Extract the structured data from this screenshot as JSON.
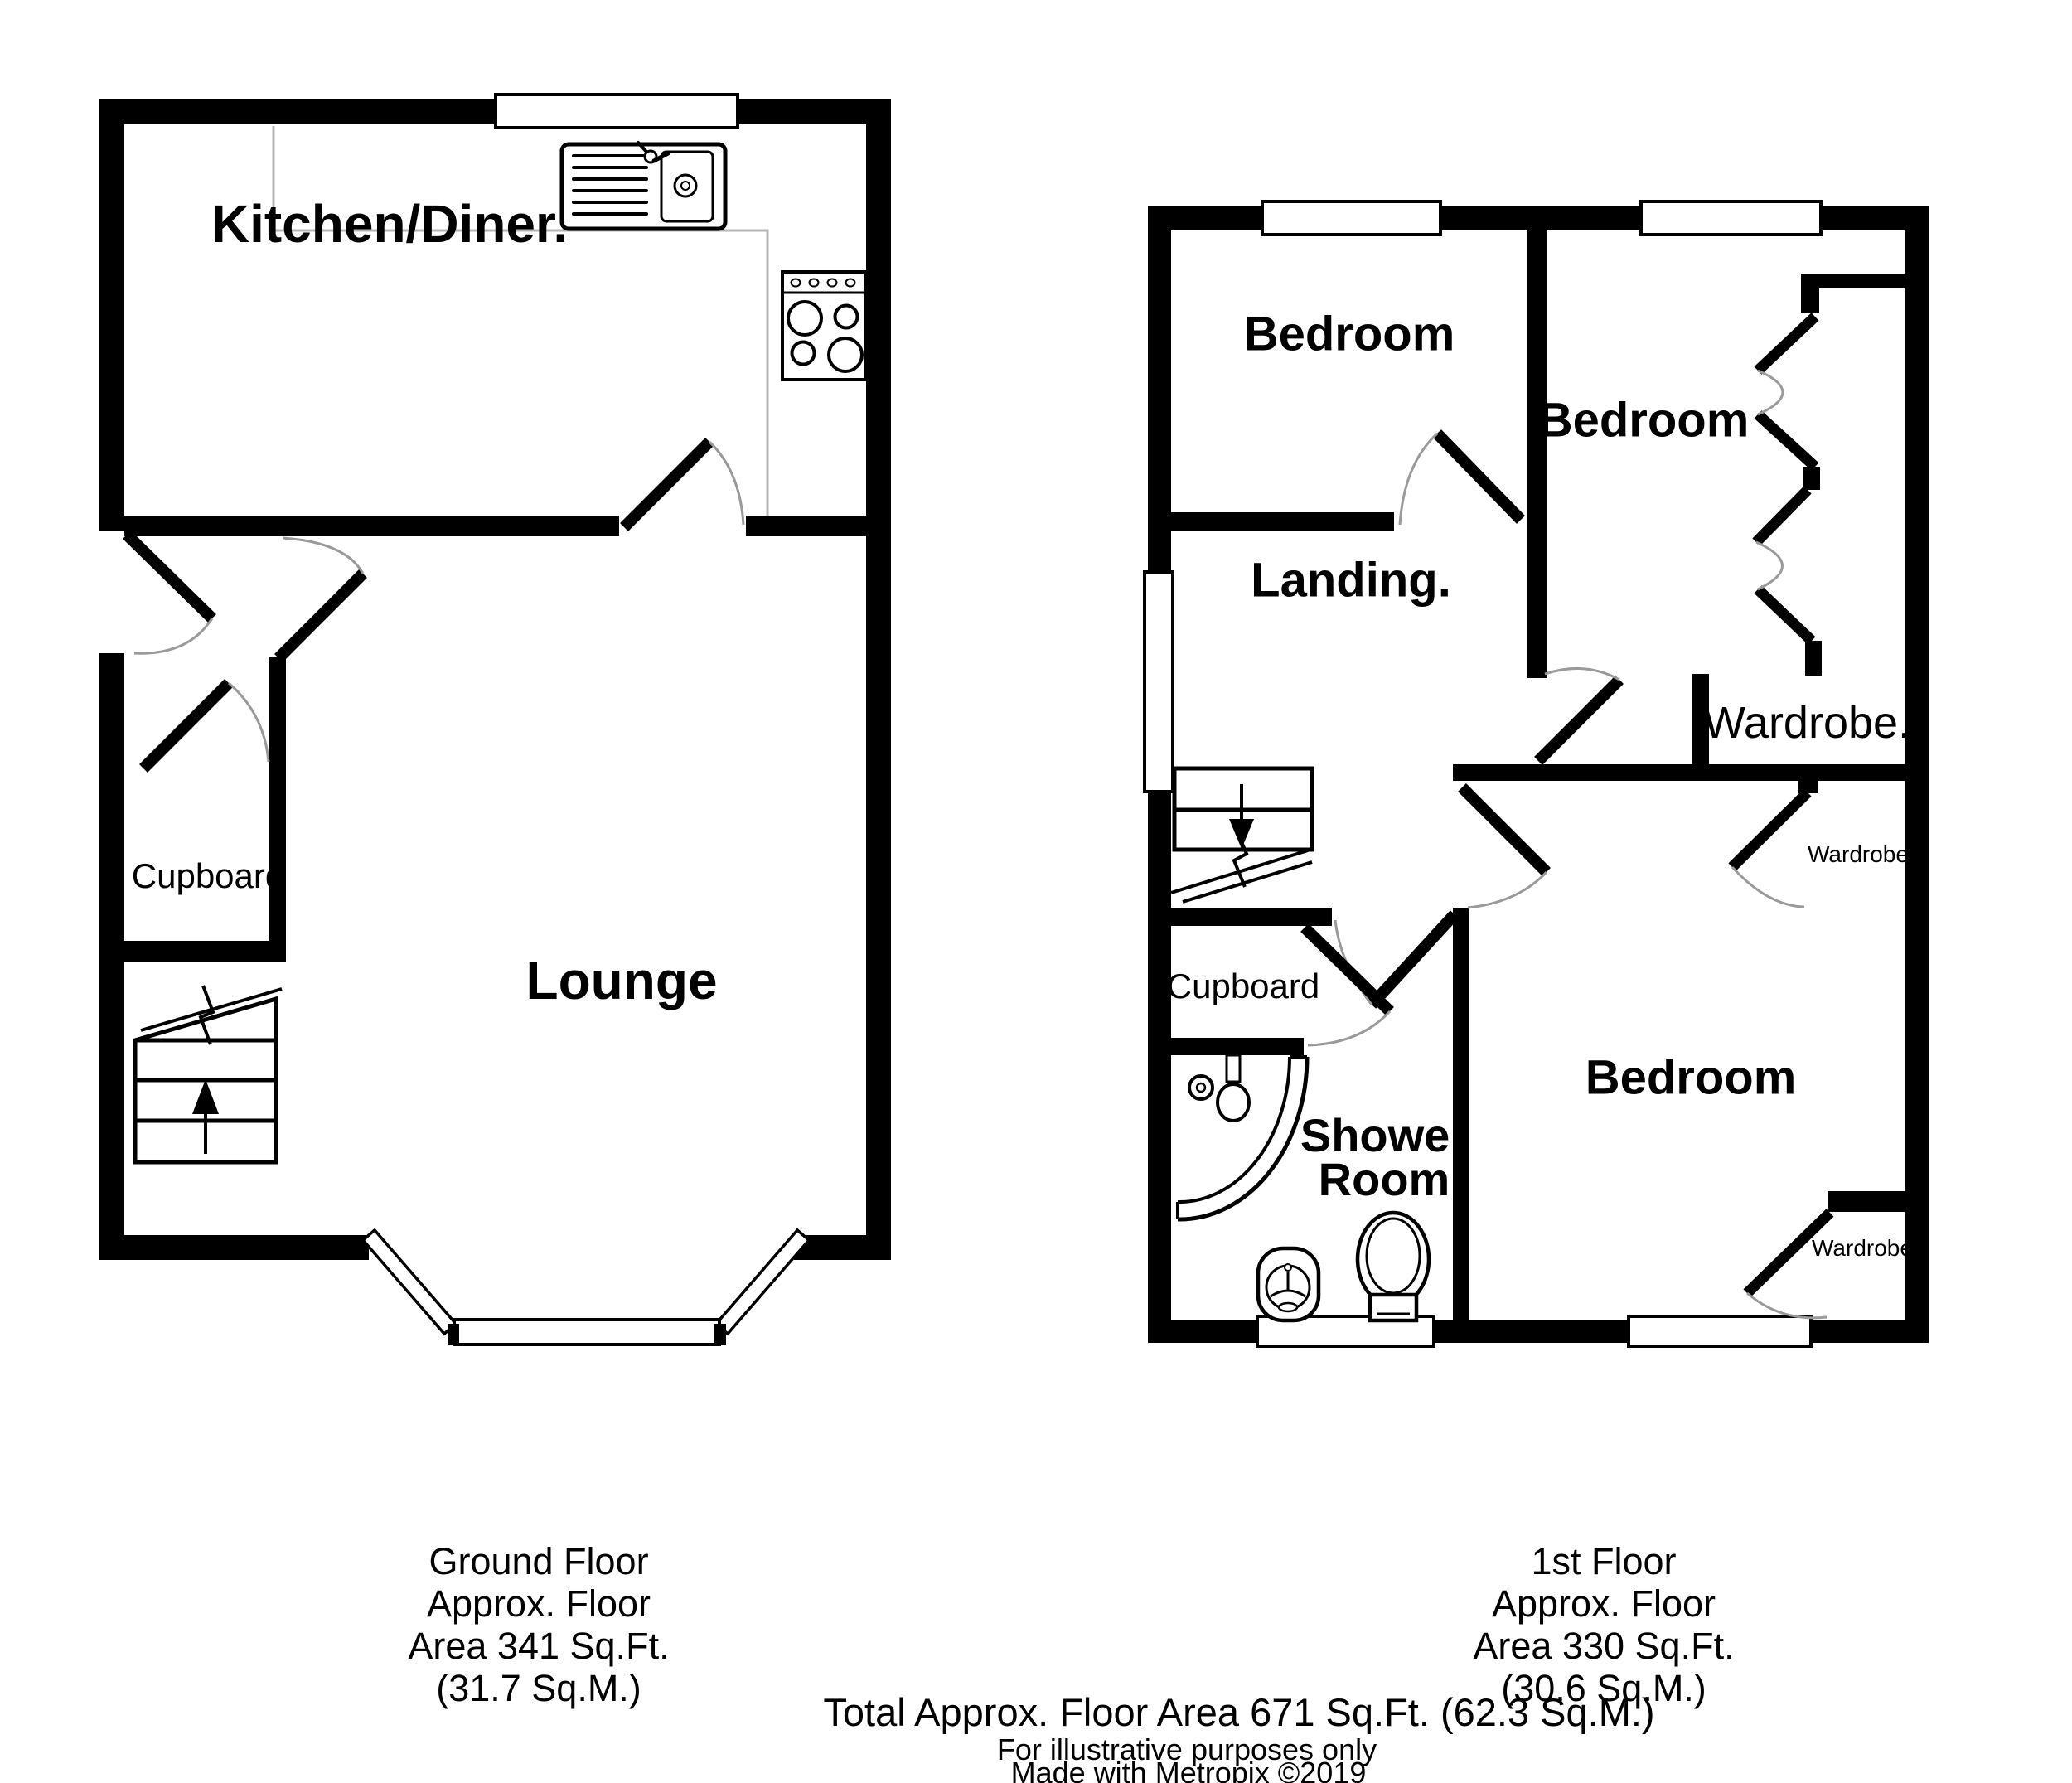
{
  "page": {
    "background": "#ffffff",
    "wall_color": "#000000",
    "door_arc_color": "#9a9a9a",
    "counter_color": "#b3b3b3"
  },
  "ground_floor": {
    "caption": {
      "line1": "Ground Floor",
      "line2": "Approx. Floor",
      "line3": "Area 341 Sq.Ft.",
      "line4": "(31.7 Sq.M.)"
    },
    "rooms": {
      "kitchen_diner": "Kitchen/Diner.",
      "lounge": "Lounge",
      "cupboard": "Cupboard"
    },
    "icons": [
      "kitchen-sink-icon",
      "cooker-hob-icon",
      "worktop-counter",
      "staircase-up-icon",
      "bay-window",
      "front-door"
    ]
  },
  "first_floor": {
    "caption": {
      "line1": "1st Floor",
      "line2": "Approx. Floor",
      "line3": "Area 330 Sq.Ft.",
      "line4": "(30.6 Sq.M.)"
    },
    "rooms": {
      "bedroom_front": "Bedroom",
      "bedroom_rear": "Bedroom",
      "bedroom_third": "Bedroom",
      "landing": "Landing.",
      "wardrobe_main": "Wardrobe.",
      "wardrobe_top": "Wardrobe",
      "wardrobe_bottom": "Wardrobe",
      "cupboard": "Cupboard",
      "shower_room": "Shower Room"
    },
    "icons": [
      "corner-shower-icon",
      "toilet-icon",
      "wash-basin-icon",
      "staircase-down-icon",
      "bifold-wardrobe-doors"
    ]
  },
  "footer": {
    "total_area": "Total Approx. Floor Area 671 Sq.Ft. (62.3 Sq.M.)",
    "disclaimer": "For illustrative purposes only",
    "credit": "Made with Metropix ©2019"
  }
}
